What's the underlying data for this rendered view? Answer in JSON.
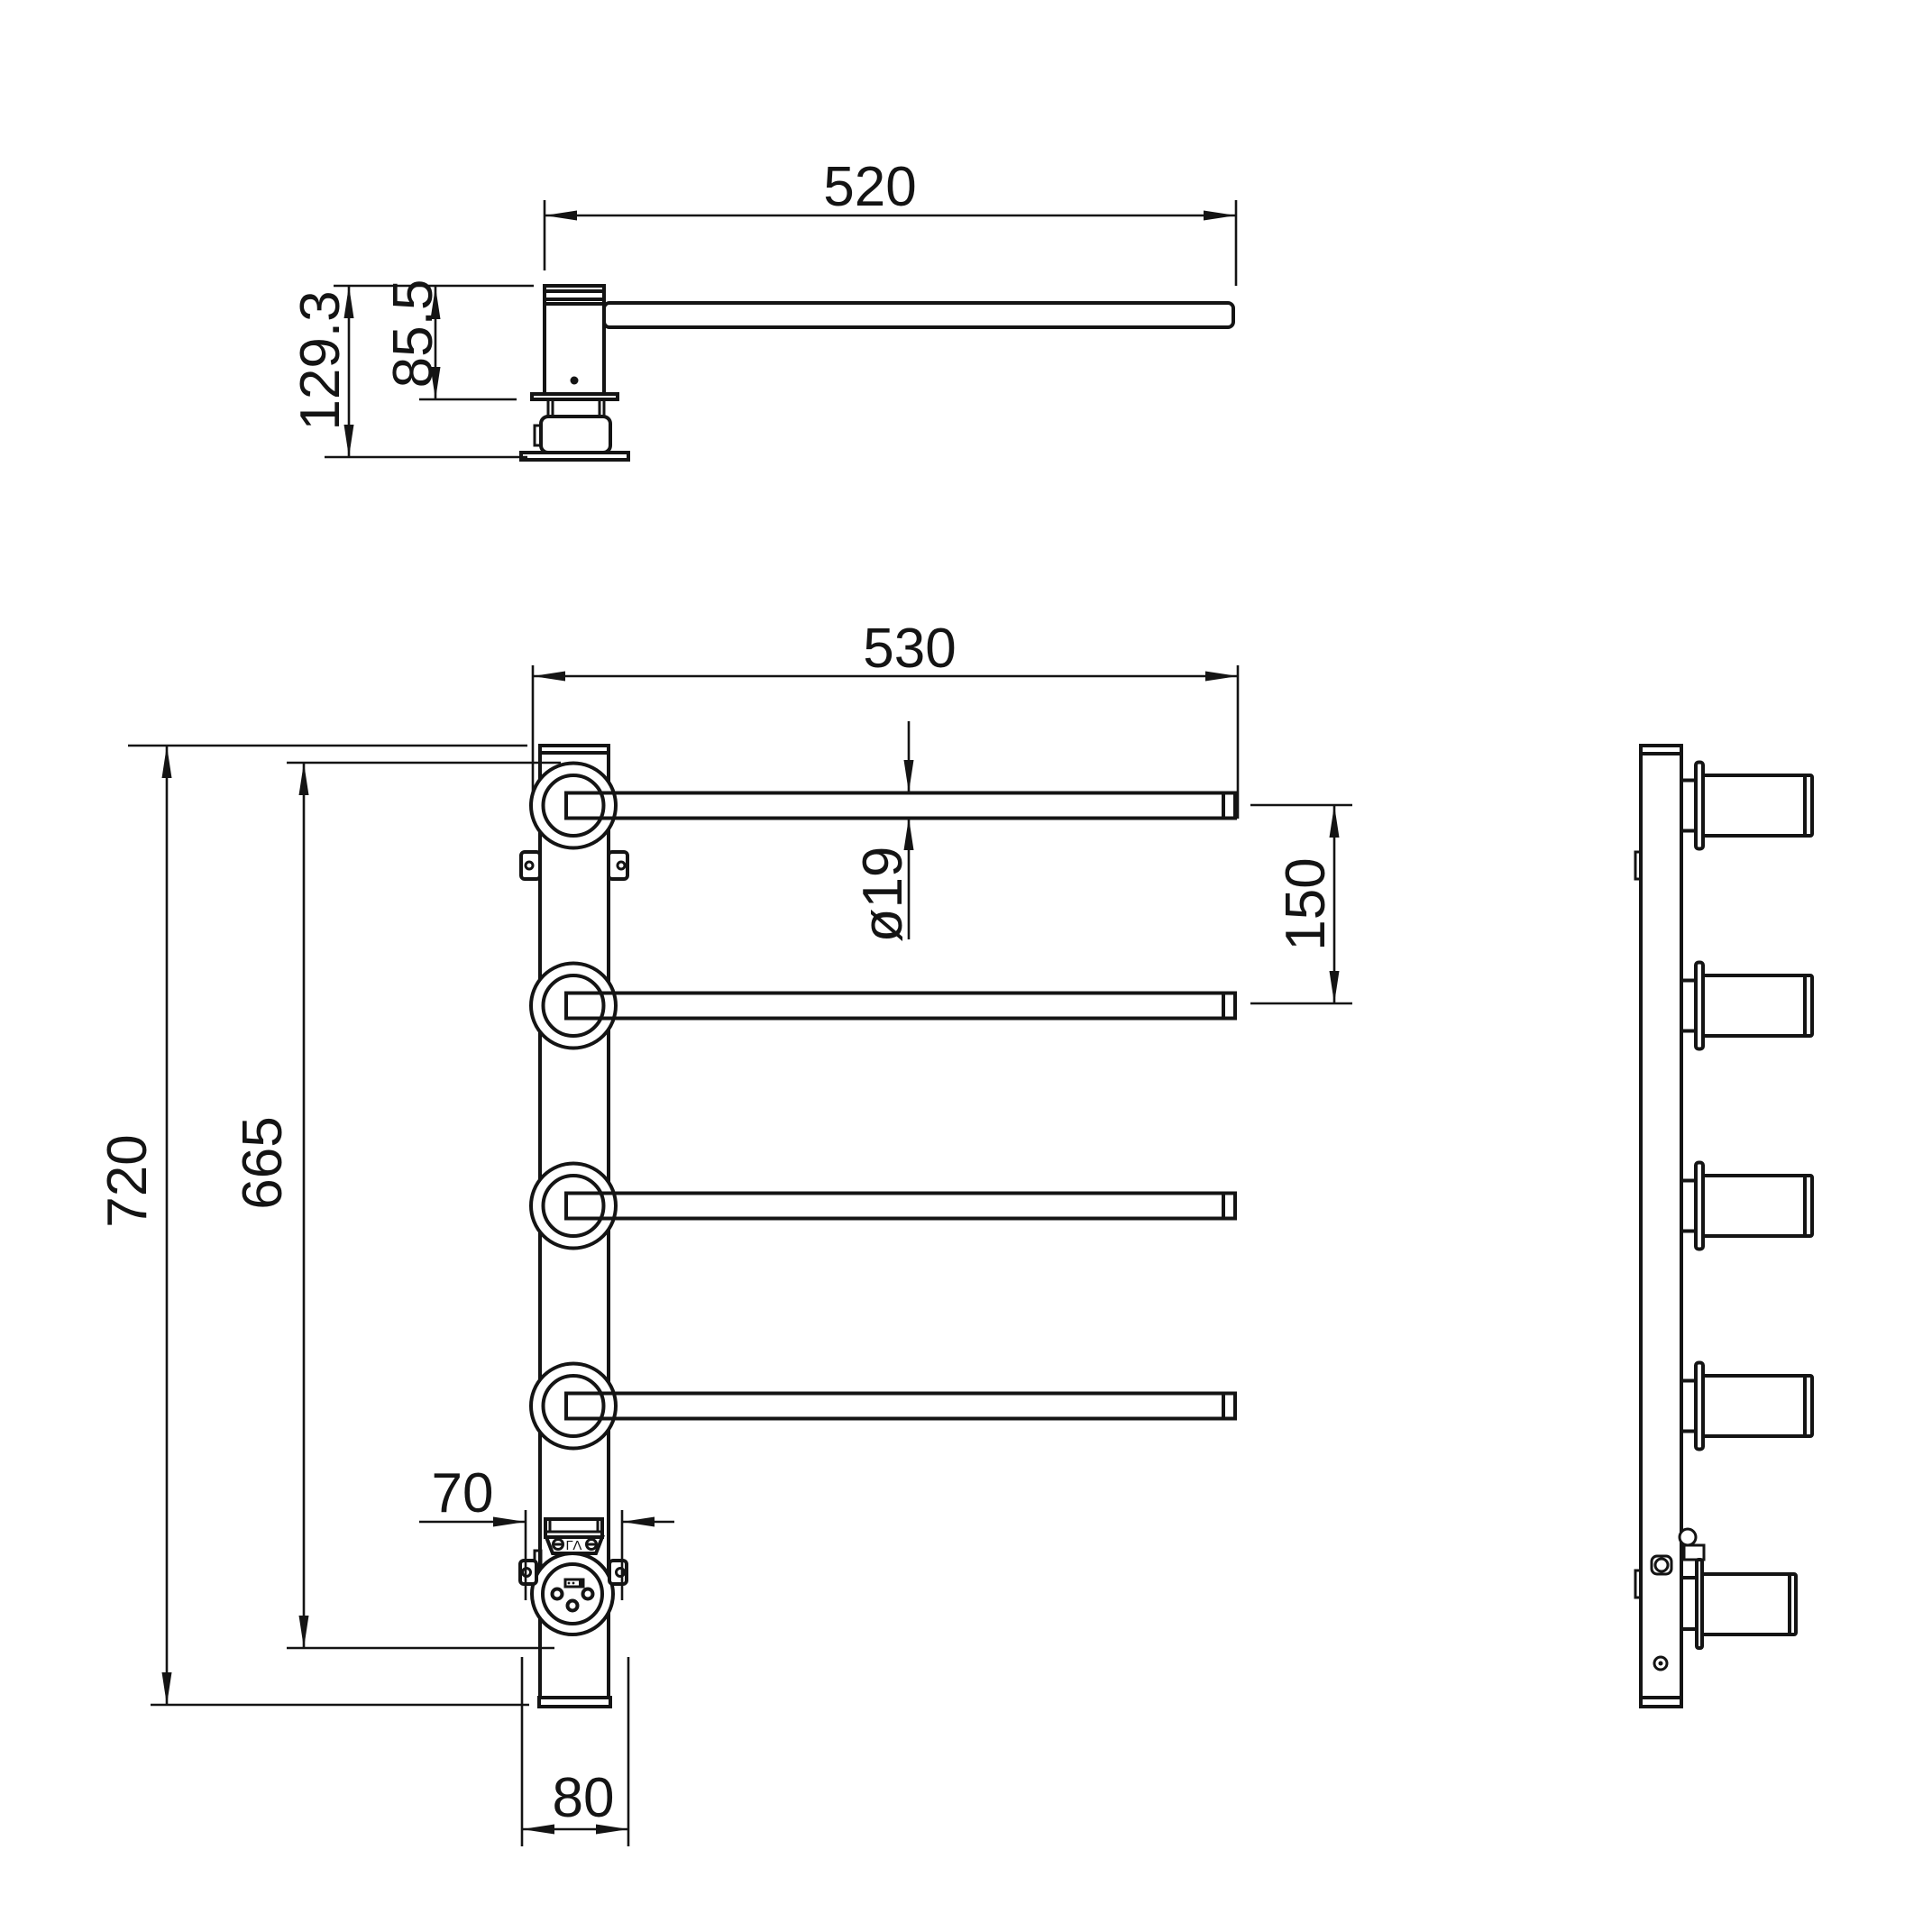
{
  "canvas": {
    "background": "#ffffff",
    "ink": "#141414"
  },
  "views": {
    "top_view": {
      "title": "top view",
      "dims": {
        "arm_length": "520",
        "overall_height": "129.3",
        "body_height": "85.5"
      }
    },
    "front_view": {
      "title": "front view",
      "dims": {
        "rail_length": "530",
        "overall_height": "720",
        "pivot_span": "665",
        "rail_spacing": "150",
        "tube_diameter": "ø19",
        "cover_width": "70",
        "base_width": "80"
      },
      "socket": {
        "marking": "ΓΛ"
      }
    },
    "side_view": {
      "title": "side view"
    }
  }
}
